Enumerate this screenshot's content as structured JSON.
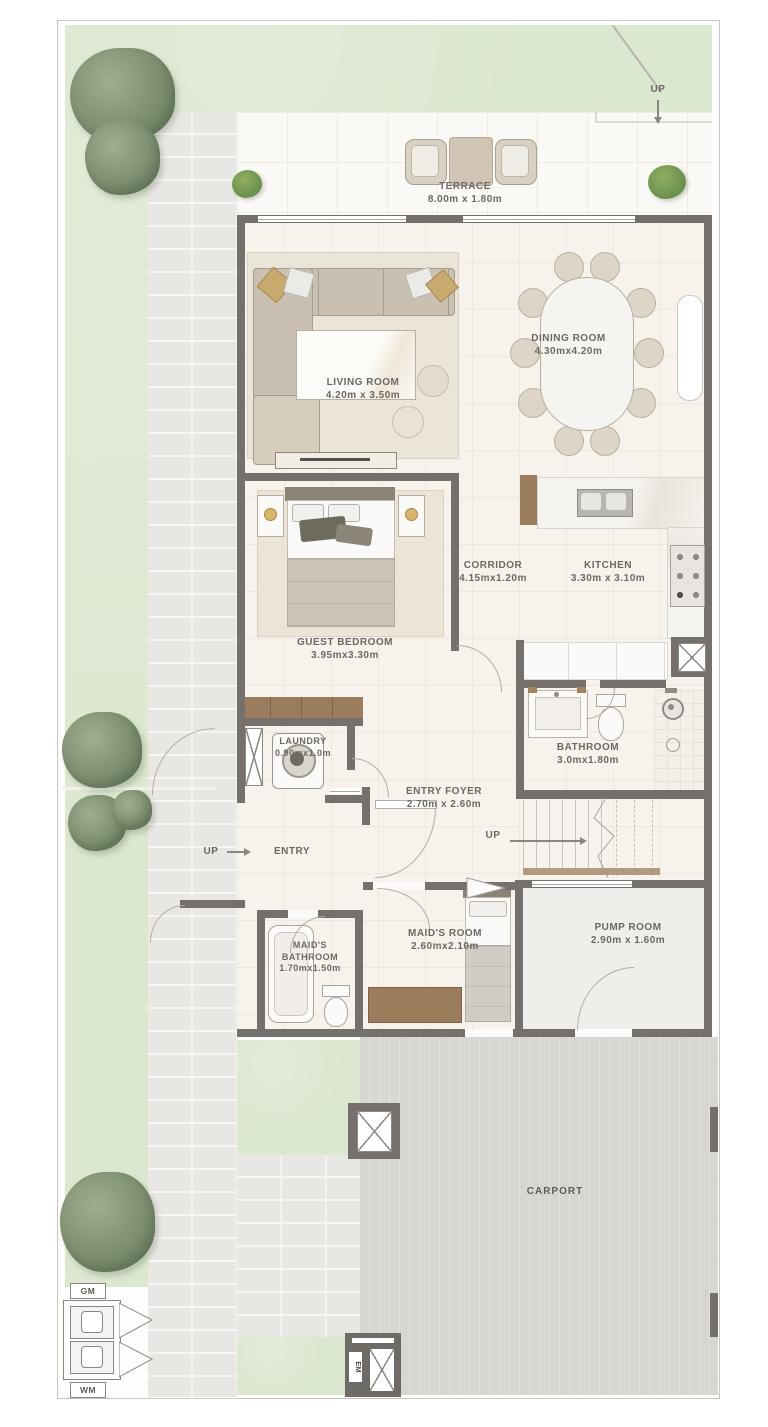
{
  "rooms": {
    "terrace": {
      "name": "TERRACE",
      "dims": "8.00m x 1.80m"
    },
    "living_room": {
      "name": "LIVING ROOM",
      "dims": "4.20m x 3.50m"
    },
    "dining_room": {
      "name": "DINING ROOM",
      "dims": "4.30mx4.20m"
    },
    "corridor": {
      "name": "CORRIDOR",
      "dims": "4.15mx1.20m"
    },
    "kitchen": {
      "name": "KITCHEN",
      "dims": "3.30m x 3.10m"
    },
    "guest_bedroom": {
      "name": "GUEST BEDROOM",
      "dims": "3.95mx3.30m"
    },
    "laundry": {
      "name": "LAUNDRY",
      "dims": "0.90mx1.0m"
    },
    "bathroom": {
      "name": "BATHROOM",
      "dims": "3.0mx1.80m"
    },
    "entry_foyer": {
      "name": "ENTRY FOYER",
      "dims": "2.70m x 2.60m"
    },
    "entry": {
      "name": "ENTRY"
    },
    "maids_room": {
      "name": "MAID'S ROOM",
      "dims": "2.60mx2.10m"
    },
    "maids_bathroom": {
      "name": "MAID'S BATHROOM",
      "dims": "1.70mx1.50m"
    },
    "pump_room": {
      "name": "PUMP ROOM",
      "dims": "2.90m x 1.60m"
    },
    "carport": {
      "name": "CARPORT"
    }
  },
  "markers": {
    "up_terrace": "UP",
    "up_entry": "UP",
    "up_stairs": "UP",
    "gas_meter": "GM",
    "water_meter": "WM",
    "electric_meter": "EM"
  },
  "colors": {
    "wall": "#75706c",
    "grass": "#dce7cf",
    "walkway": "#e9e7e4",
    "carport": "#d8d6d3",
    "floor": "#f7f2ec",
    "wood": "#9b7c5d"
  }
}
